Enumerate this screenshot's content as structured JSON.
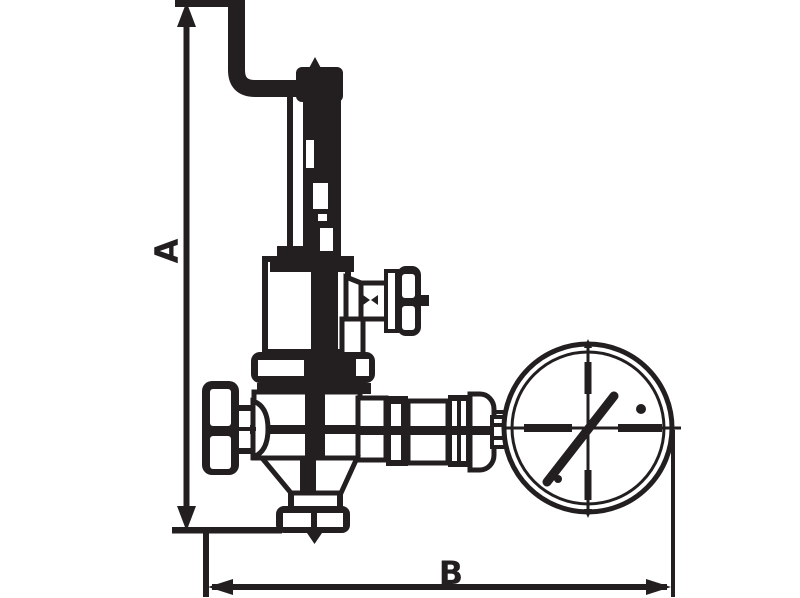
{
  "diagram": {
    "type": "technical-drawing",
    "subject": "pressure reducing valve with pressure gauge, dimensioned outline drawing",
    "dimension_labels": {
      "vertical": "A",
      "horizontal": "B"
    },
    "colors": {
      "ink": "#231f20",
      "background": "#ffffff"
    },
    "parts": [
      "inlet-pipe-elbow",
      "adjusting-cap",
      "bonnet-stem",
      "spring-housing",
      "side-cock-t-handle",
      "valve-body",
      "handwheel",
      "outlet-union",
      "pressure-gauge",
      "bottom-flange"
    ]
  }
}
